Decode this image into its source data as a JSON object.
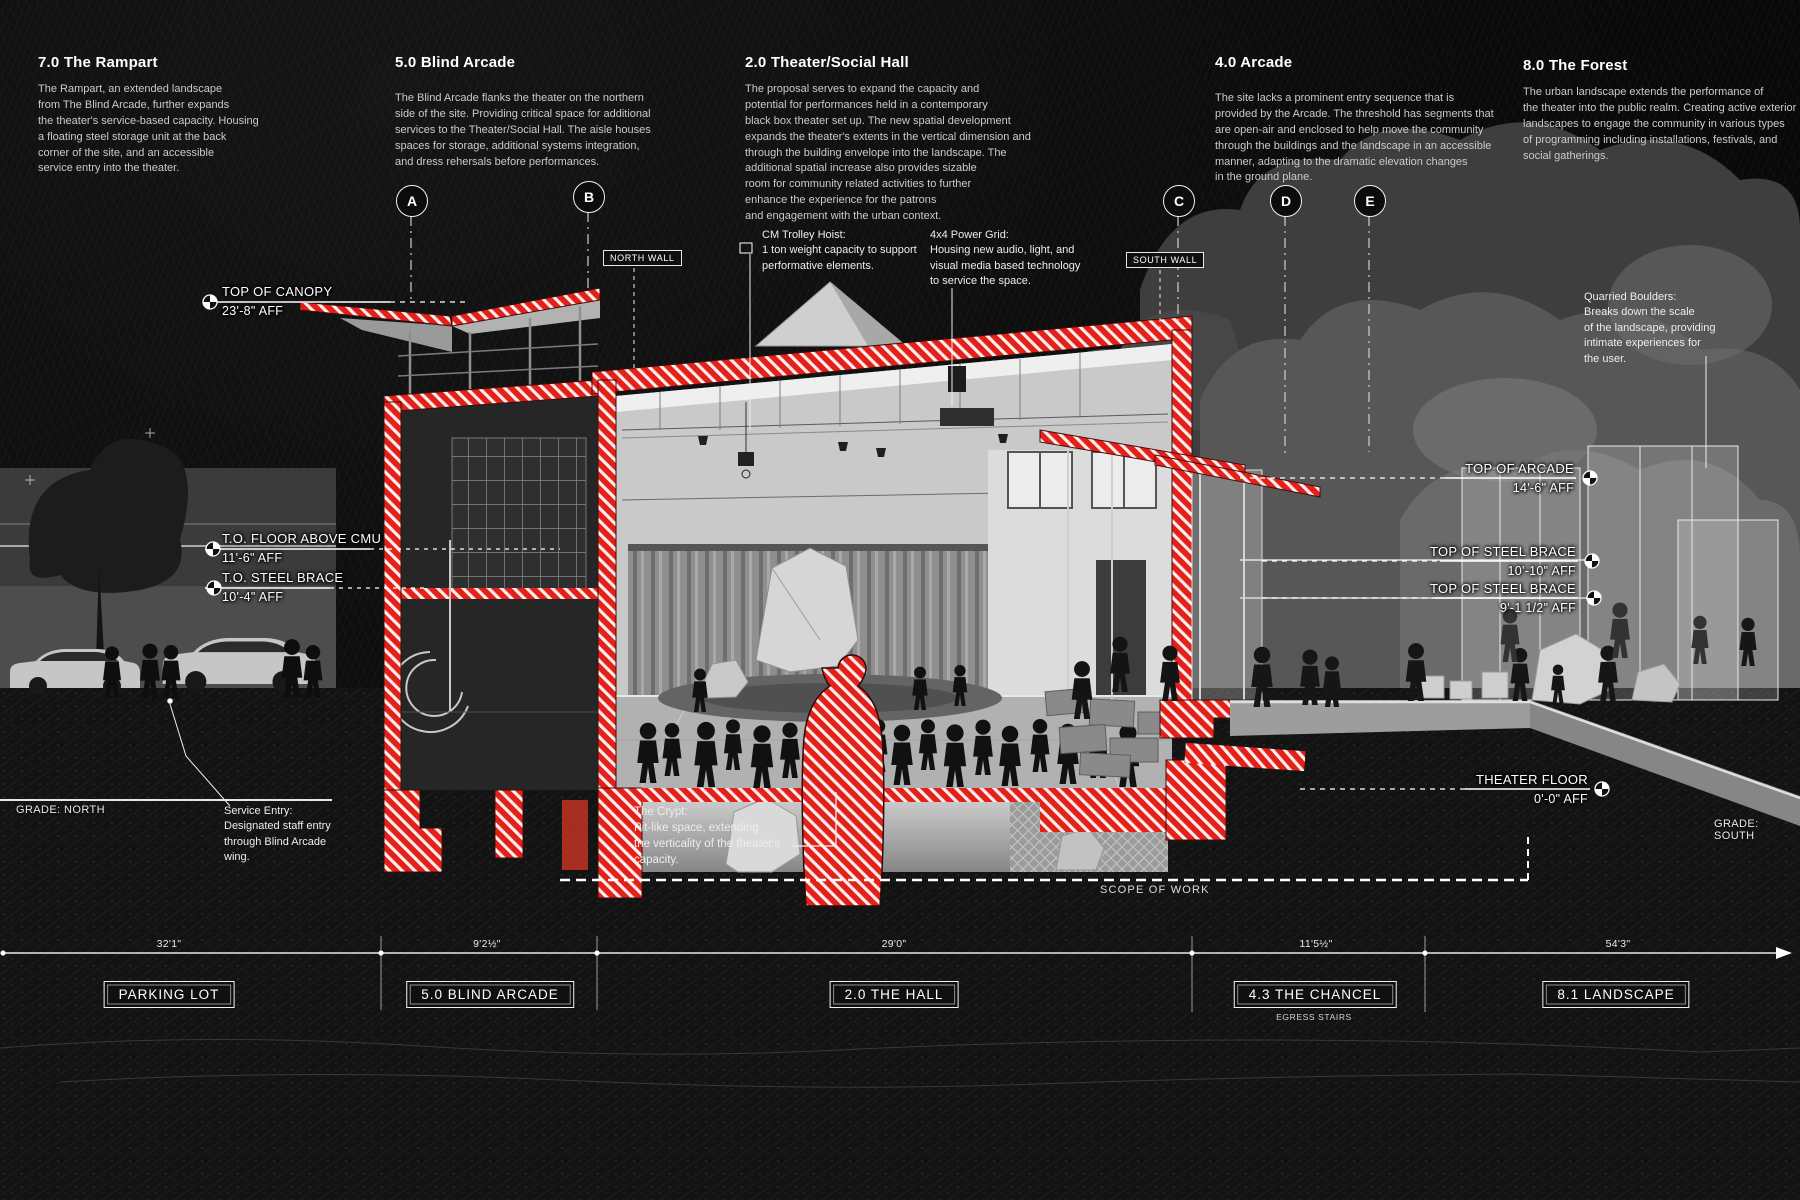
{
  "colors": {
    "accent": "#e32119",
    "background": "#0b0b0b",
    "text": "#ffffff"
  },
  "sections": [
    {
      "title": "7.0 The Rampart",
      "body": "The Rampart, an extended landscape\nfrom The Blind Arcade, further expands\nthe theater's service-based capacity. Housing\na floating steel storage unit at the back\ncorner of the site, and an accessible\nservice entry into the theater."
    },
    {
      "title": "5.0 Blind Arcade",
      "body": "The Blind Arcade flanks the theater on the northern\nside of the site. Providing critical space for additional\nservices to the Theater/Social Hall. The aisle houses\nspaces for storage, additional systems integration,\nand dress rehersals before performances."
    },
    {
      "title": "2.0 Theater/Social Hall",
      "body": "The proposal serves to expand the capacity and\npotential for performances held in a contemporary\nblack box theater set up. The new spatial development\nexpands the theater's extents in the vertical dimension and\nthrough the building envelope into the landscape. The\nadditional spatial increase also provides sizable\nroom for community related activities to further\nenhance the experience for the patrons\nand engagement with the urban context."
    },
    {
      "title": "4.0 Arcade",
      "body": "The site lacks a prominent entry sequence that is\nprovided by the Arcade. The threshold has segments that\nare open-air and enclosed to help move the community\nthrough the buildings and the landscape in an accessible\nmanner, adapting to the dramatic elevation changes\nin the ground plane."
    },
    {
      "title": "8.0 The Forest",
      "body": "The urban landscape extends the performance of\nthe theater into the public realm. Creating active exterior\nlandscapes to engage the community in various types\nof programming including installations, festivals, and\nsocial gatherings."
    }
  ],
  "grid_markers": [
    "A",
    "B",
    "C",
    "D",
    "E"
  ],
  "wall_tags": {
    "north": "NORTH WALL",
    "south": "SOUTH WALL"
  },
  "callouts": {
    "trolley_hoist": "CM Trolley Hoist:\n1 ton weight capacity to support\nperformative elements.",
    "power_grid": "4x4 Power Grid:\nHousing new audio, light, and\nvisual media based technology\nto service the space.",
    "quarried_boulders": "Quarried Boulders:\nBreaks down the scale\nof the landscape, providing\nintimate experiences for\nthe user.",
    "service_entry": "Service Entry:\nDesignated staff entry\nthrough Blind Arcade\nwing.",
    "crypt": "The Crypt:\nPit-like space, extending\nthe verticality of the theater's\ncapacity."
  },
  "elevation_labels": {
    "left": [
      {
        "name": "TOP OF CANOPY",
        "value": "23'-8\" AFF"
      },
      {
        "name": "T.O. FLOOR ABOVE CMU",
        "value": "11'-6\" AFF"
      },
      {
        "name": "T.O. STEEL BRACE",
        "value": "10'-4\" AFF"
      }
    ],
    "right": [
      {
        "name": "TOP OF ARCADE",
        "value": "14'-6\" AFF"
      },
      {
        "name": "TOP OF STEEL BRACE",
        "value": "10'-10\" AFF"
      },
      {
        "name": "TOP OF STEEL BRACE",
        "value": "9'-1 1/2\" AFF"
      },
      {
        "name": "THEATER FLOOR",
        "value": "0'-0\" AFF"
      }
    ]
  },
  "grade_labels": {
    "north": "GRADE: NORTH",
    "south": "GRADE: SOUTH"
  },
  "scope_label": "SCOPE OF WORK",
  "dimension_bar": {
    "zones": [
      {
        "dimension": "32'1\"",
        "label": "PARKING LOT"
      },
      {
        "dimension": "9'2½\"",
        "label": "5.0 BLIND ARCADE"
      },
      {
        "dimension": "29'0\"",
        "label": "2.0 THE HALL"
      },
      {
        "dimension": "11'5½\"",
        "label": "4.3 THE CHANCEL"
      },
      {
        "dimension": "54'3\"",
        "label": "8.1 LANDSCAPE"
      }
    ],
    "sub_label": "EGRESS STAIRS"
  }
}
